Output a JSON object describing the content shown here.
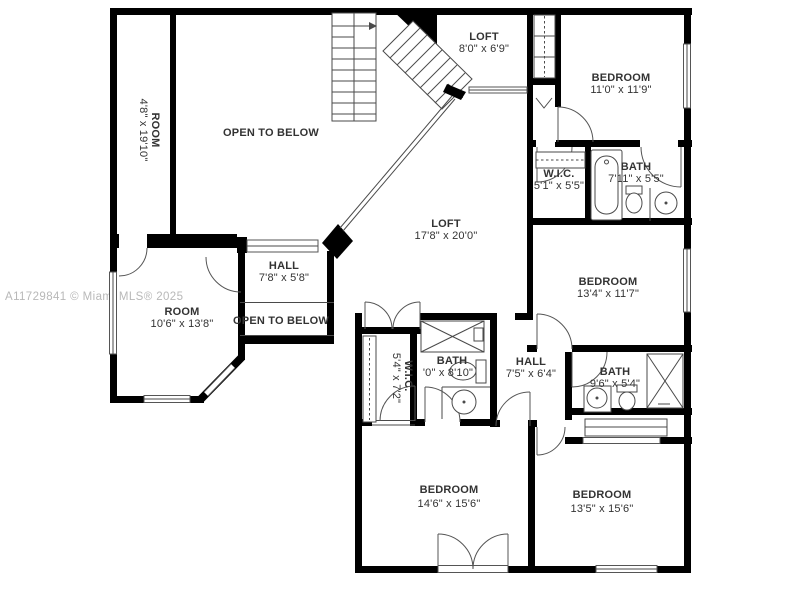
{
  "image_type": "real-estate floor plan (upper level)",
  "watermark": "A11729841 © Miami MLS® 2025",
  "palette": {
    "background": "#ffffff",
    "wall": "#000000",
    "thin_line": "#4a4a4a",
    "label_text": "#333333",
    "watermark_text": "#b8b8b8"
  },
  "rooms": {
    "room_narrow": {
      "name": "ROOM",
      "dims": "4'8\" x 19'10\""
    },
    "open_upper": {
      "name": "OPEN TO BELOW"
    },
    "loft_small": {
      "name": "LOFT",
      "dims": "8'0\" x 6'9\""
    },
    "bedroom_top_right": {
      "name": "BEDROOM",
      "dims": "11'0\" x 11'9\""
    },
    "wic_top_right": {
      "name": "W.I.C.",
      "dims": "5'1\" x 5'5\""
    },
    "bath_top_right": {
      "name": "BATH",
      "dims": "7'11\" x 5'5\""
    },
    "loft_main": {
      "name": "LOFT",
      "dims": "17'8\" x 20'0\""
    },
    "hall_left": {
      "name": "HALL",
      "dims": "7'8\" x 5'8\""
    },
    "bedroom_right": {
      "name": "BEDROOM",
      "dims": "13'4\" x 11'7\""
    },
    "room_bottom_left": {
      "name": "ROOM",
      "dims": "10'6\" x 13'8\""
    },
    "open_bridge": {
      "name": "OPEN TO BELOW"
    },
    "wic_center": {
      "name": "W.I.C.",
      "dims": "5'4\" x 7'2\""
    },
    "bath_center": {
      "name": "BATH",
      "dims": "'0\" x 8'10\""
    },
    "hall_center": {
      "name": "HALL",
      "dims": "7'5\" x 6'4\""
    },
    "bath_right": {
      "name": "BATH",
      "dims": "9'6\" x 5'4\""
    },
    "bedroom_bottom_left": {
      "name": "BEDROOM",
      "dims": "14'6\" x 15'6\""
    },
    "bedroom_bottom_right": {
      "name": "BEDROOM",
      "dims": "13'5\" x 15'6\""
    }
  }
}
